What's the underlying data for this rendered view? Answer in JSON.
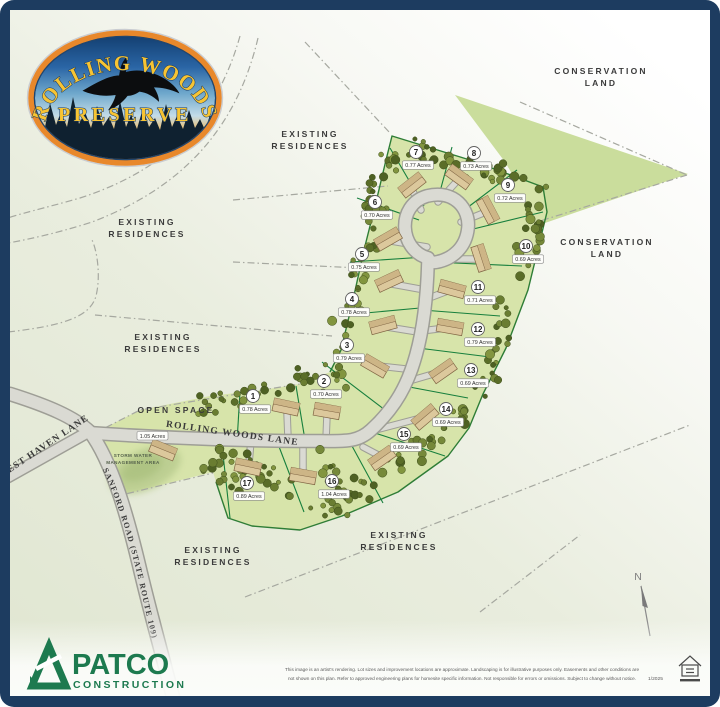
{
  "logo": {
    "arc_text": "ROLLING WOODS",
    "name": "PRESERVE"
  },
  "map": {
    "area_labels": [
      {
        "line1": "EXISTING",
        "line2": "RESIDENCES",
        "x": 310,
        "y": 137
      },
      {
        "line1": "EXISTING",
        "line2": "RESIDENCES",
        "x": 147,
        "y": 225
      },
      {
        "line1": "EXISTING",
        "line2": "RESIDENCES",
        "x": 163,
        "y": 340
      },
      {
        "line1": "EXISTING",
        "line2": "RESIDENCES",
        "x": 213,
        "y": 553
      },
      {
        "line1": "EXISTING",
        "line2": "RESIDENCES",
        "x": 399,
        "y": 538
      },
      {
        "line1": "CONSERVATION",
        "line2": "LAND",
        "x": 601,
        "y": 74
      },
      {
        "line1": "CONSERVATION",
        "line2": "LAND",
        "x": 607,
        "y": 245
      },
      {
        "line1": "OPEN SPACE",
        "line2": "",
        "x": 176,
        "y": 413
      }
    ],
    "road_labels": {
      "rolling_woods": "ROLLING WOODS LANE",
      "west_haven": "WEST HAVEN LANE",
      "sanford": "SANFORD ROAD (STATE ROUTE 109)"
    },
    "storm_water": {
      "line1": "STORM WATER",
      "line2": "MANAGEMENT AREA"
    },
    "open_space_chip": "1.05 Acres",
    "north_label": "N",
    "lots": [
      {
        "num": "1",
        "acres": "0.78 Acres",
        "x": 253,
        "y": 396
      },
      {
        "num": "2",
        "acres": "0.70 Acres",
        "x": 324,
        "y": 381
      },
      {
        "num": "3",
        "acres": "0.79 Acres",
        "x": 347,
        "y": 345
      },
      {
        "num": "4",
        "acres": "0.78 Acres",
        "x": 352,
        "y": 299
      },
      {
        "num": "5",
        "acres": "0.75 Acres",
        "x": 362,
        "y": 254
      },
      {
        "num": "6",
        "acres": "0.70 Acres",
        "x": 375,
        "y": 202
      },
      {
        "num": "7",
        "acres": "0.77 Acres",
        "x": 416,
        "y": 152
      },
      {
        "num": "8",
        "acres": "0.73 Acres",
        "x": 474,
        "y": 153
      },
      {
        "num": "9",
        "acres": "0.72 Acres",
        "x": 508,
        "y": 185
      },
      {
        "num": "10",
        "acres": "0.69 Acres",
        "x": 526,
        "y": 246
      },
      {
        "num": "11",
        "acres": "0.71 Acres",
        "x": 478,
        "y": 287
      },
      {
        "num": "12",
        "acres": "0.79 Acres",
        "x": 478,
        "y": 329
      },
      {
        "num": "13",
        "acres": "0.69 Acres",
        "x": 471,
        "y": 370
      },
      {
        "num": "14",
        "acres": "0.69 Acres",
        "x": 446,
        "y": 409
      },
      {
        "num": "15",
        "acres": "0.69 Acres",
        "x": 404,
        "y": 434
      },
      {
        "num": "16",
        "acres": "1.04 Acres",
        "x": 332,
        "y": 481
      },
      {
        "num": "17",
        "acres": "0.89 Acres",
        "x": 247,
        "y": 483
      }
    ]
  },
  "developer": {
    "name": "PATCO",
    "division": "CONSTRUCTION"
  },
  "footer": {
    "disclaimer_line1": "This image is an artist's rendering. Lot sizes and improvement locations are approximate. Landscaping is for illustrative purposes only. Easements and other conditions are",
    "disclaimer_line2": "not shown on this plan. Refer to approved engineering plans for homesite specific information. Not responsible for errors or omissions. Subject to change without notice.",
    "date": "1/2025"
  },
  "colors": {
    "frame": "#1d3c60",
    "parcel_green": "#d7e4aa",
    "conservation_green": "#cadd9c",
    "lot_line_green": "#177f3d",
    "road_fill": "#dadad3",
    "road_edge": "#9e9e96",
    "house_tan": "#dcc89c",
    "patco_green": "#1d7a4f",
    "logo_gold": "#f7c433"
  }
}
